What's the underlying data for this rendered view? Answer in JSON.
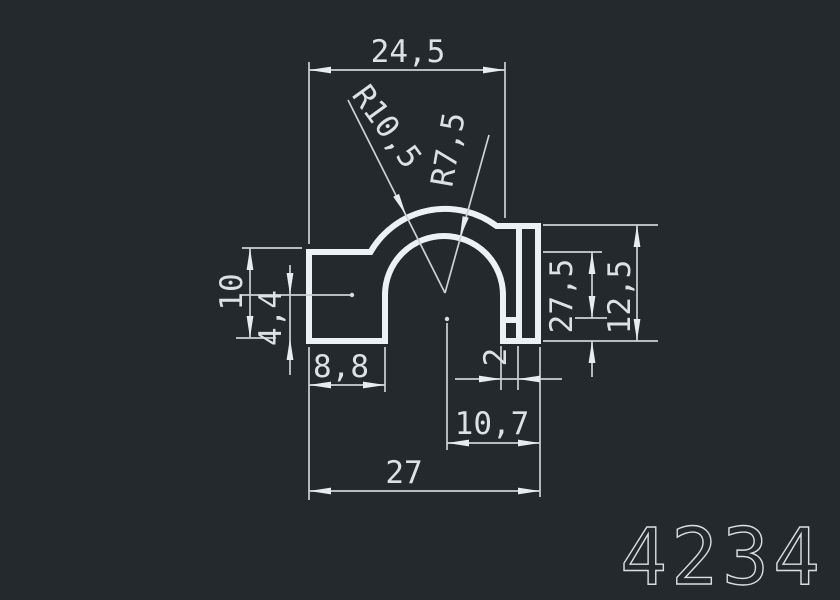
{
  "drawing": {
    "type": "cad-profile-cross-section",
    "background_color": "#24292e",
    "line_color": "#eef1f3",
    "dim_line_color": "#ccd1d5",
    "text_color": "#dde1e4",
    "part_number": "4234",
    "dimensions": {
      "top_width": "24,5",
      "outer_radius": "R10,5",
      "inner_radius": "R7,5",
      "left_height": "10",
      "left_wall_height": "4,4",
      "left_foot_width": "8,8",
      "right_step_height": "27,5",
      "right_height": "12,5",
      "slot_width": "2",
      "center_to_right": "10,7",
      "total_width": "27"
    }
  }
}
